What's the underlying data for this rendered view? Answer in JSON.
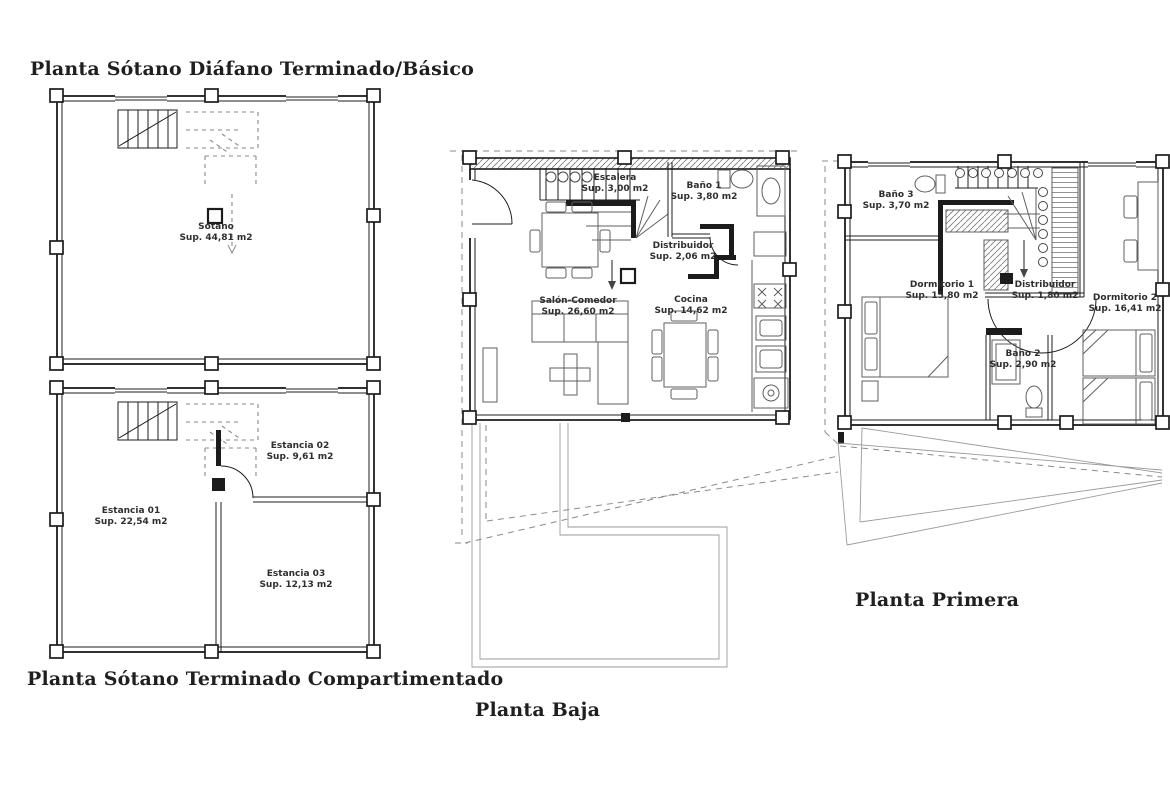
{
  "page": {
    "background": "#ffffff",
    "ink": "#1c1c1c",
    "furniture_ink": "#5f5f5f",
    "ghost_ink": "#8a8a8a"
  },
  "plans": [
    {
      "id": "sotano-diafano",
      "title": "Planta Sótano Diáfano Terminado/Básico",
      "rooms": [
        {
          "name": "Sótano",
          "area": "Sup. 44,81 m2"
        }
      ]
    },
    {
      "id": "sotano-compartimentado",
      "title": "Planta Sótano Terminado Compartimentado",
      "rooms": [
        {
          "name": "Estancia 01",
          "area": "Sup. 22,54 m2"
        },
        {
          "name": "Estancia 02",
          "area": "Sup. 9,61 m2"
        },
        {
          "name": "Estancia 03",
          "area": "Sup. 12,13 m2"
        }
      ]
    },
    {
      "id": "planta-baja",
      "title": "Planta Baja",
      "rooms": [
        {
          "name": "Escalera",
          "area": "Sup. 3,00 m2"
        },
        {
          "name": "Baño 1",
          "area": "Sup. 3,80 m2"
        },
        {
          "name": "Distribuidor",
          "area": "Sup. 2,06 m2"
        },
        {
          "name": "Salón-Comedor",
          "area": "Sup. 26,60 m2"
        },
        {
          "name": "Cocina",
          "area": "Sup. 14,62 m2"
        }
      ]
    },
    {
      "id": "planta-primera",
      "title": "Planta Primera",
      "rooms": [
        {
          "name": "Baño 3",
          "area": "Sup. 3,70 m2"
        },
        {
          "name": "Dormitorio 1",
          "area": "Sup. 15,80 m2"
        },
        {
          "name": "Distribuidor",
          "area": "Sup. 1,80 m2"
        },
        {
          "name": "Dormitorio 2",
          "area": "Sup. 16,41 m2"
        },
        {
          "name": "Baño 2",
          "area": "Sup. 2,90 m2"
        }
      ]
    }
  ]
}
